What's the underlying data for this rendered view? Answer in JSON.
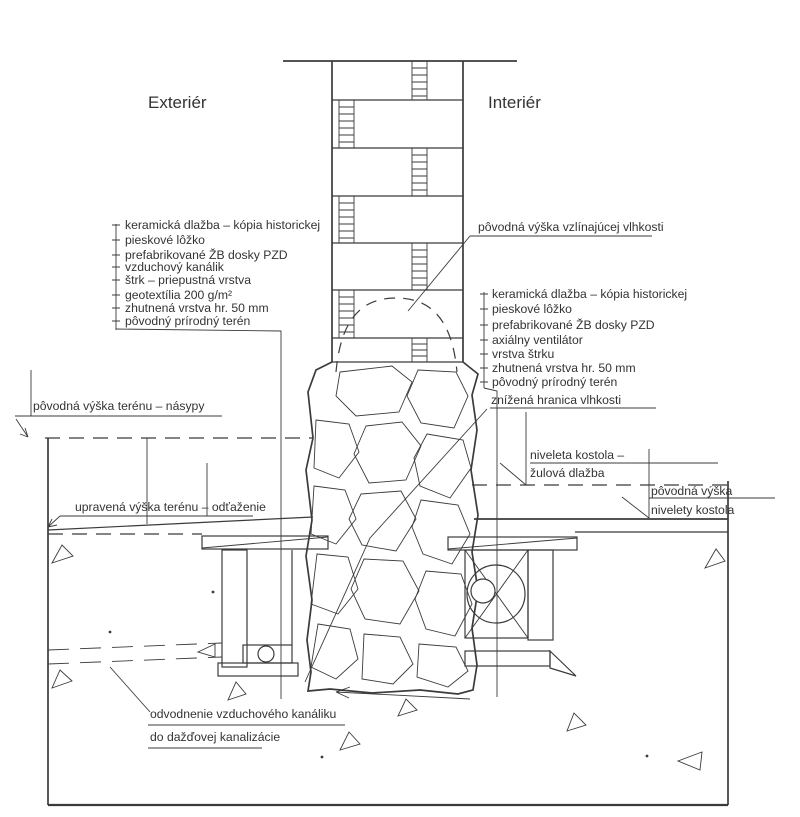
{
  "drawing": {
    "header": {
      "exterior": "Exteriér",
      "interior": "Interiér"
    },
    "left_block": {
      "items": [
        "keramická dlažba – kópia historickej",
        "pieskové lôžko",
        "prefabrikované ŽB dosky PZD",
        "vzduchový kanálik",
        "štrk – priepustná vrstva",
        "geotextília 200 g/m²",
        "zhutnená vrstva hr. 50 mm",
        "pôvodný prírodný terén"
      ]
    },
    "right_block": {
      "moisture_top": "pôvodná výška vzlínajúcej vlhkosti",
      "items": [
        "keramická dlažba – kópia historickej",
        "pieskové lôžko",
        "prefabrikované ŽB dosky PZD",
        "axiálny ventilátor",
        "vrstva štrku",
        "zhutnená vrstva hr. 50 mm",
        "pôvodný prírodný terén"
      ],
      "moisture_bottom": "znížená hranica vlhkosti"
    },
    "exterior_labels": {
      "original_terrain": "pôvodná výška terénu – násypy",
      "modified_terrain": "upravená výška terénu – odťaženie"
    },
    "interior_labels": {
      "church_level_line1": "niveleta kostola –",
      "church_level_line2": "žulová dlažba",
      "original_level_line1": "pôvodná výška",
      "original_level_line2": "nivelety kostola"
    },
    "drain_label": {
      "line1": "odvodnenie vzduchového kanáliku",
      "line2": "do dažďovej kanalizácie"
    },
    "colors": {
      "line": "#3b3b3b",
      "text": "#333333",
      "background": "#ffffff"
    }
  }
}
